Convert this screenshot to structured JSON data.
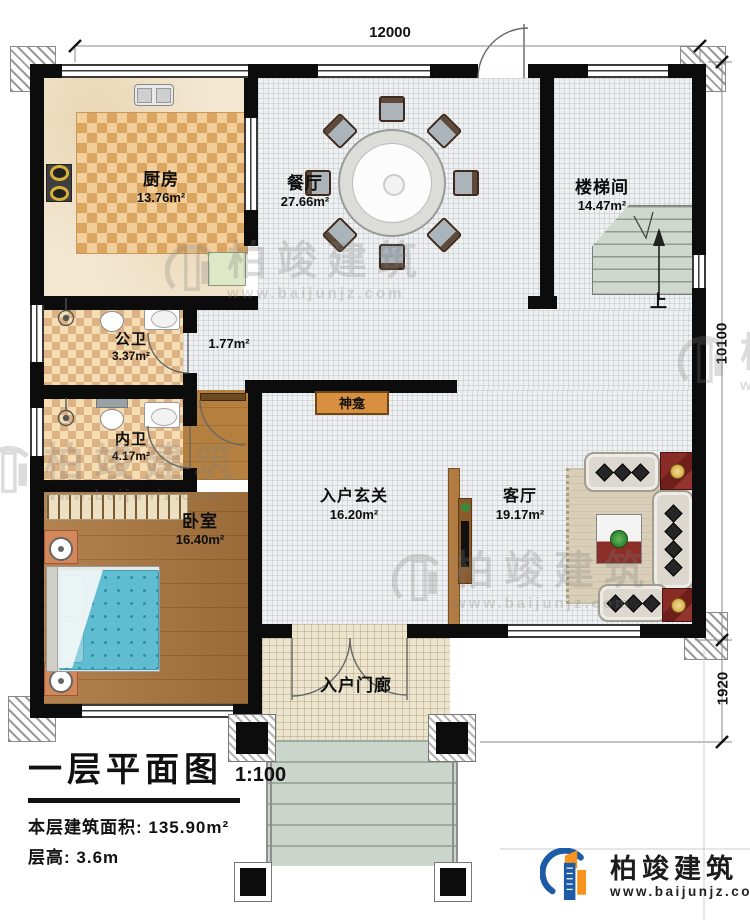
{
  "title_block": {
    "drawing_title": "一层平面图",
    "scale": "1:100",
    "area_label": "本层建筑面积: ",
    "area_value": "135.90m²",
    "height_label": "层高: ",
    "height_value": "3.6m"
  },
  "dimensions": {
    "width": "12000",
    "height_main": "10100",
    "height_porch": "1920"
  },
  "rooms": {
    "kitchen": {
      "name": "厨房",
      "area": "13.76m²"
    },
    "dining": {
      "name": "餐厅",
      "area": "27.66m²"
    },
    "stairwell": {
      "name": "楼梯间",
      "area": "14.47m²"
    },
    "public_bath": {
      "name": "公卫",
      "area": "3.37m²"
    },
    "corridor": {
      "area": "1.77m²"
    },
    "private_bath": {
      "name": "内卫",
      "area": "4.17m²"
    },
    "bedroom": {
      "name": "卧室",
      "area": "16.40m²"
    },
    "foyer": {
      "name": "入户玄关",
      "area": "16.20m²"
    },
    "living_room": {
      "name": "客厅",
      "area": "19.17m²"
    },
    "porch": {
      "name": "入户门廊"
    },
    "shrine": {
      "name": "神龛"
    },
    "stairs": {
      "direction": "上"
    }
  },
  "watermark": {
    "brand": "柏竣建筑",
    "site": "www.baijunjz.com"
  },
  "logo": {
    "brand": "柏竣建筑",
    "site": "www.baijunjz.com"
  },
  "colors": {
    "wall": "#0c0c0c",
    "wood": "#a9753d",
    "bed": "#5fbcd1",
    "logo_blue": "#1d5ba6",
    "logo_orange": "#f7941d"
  }
}
